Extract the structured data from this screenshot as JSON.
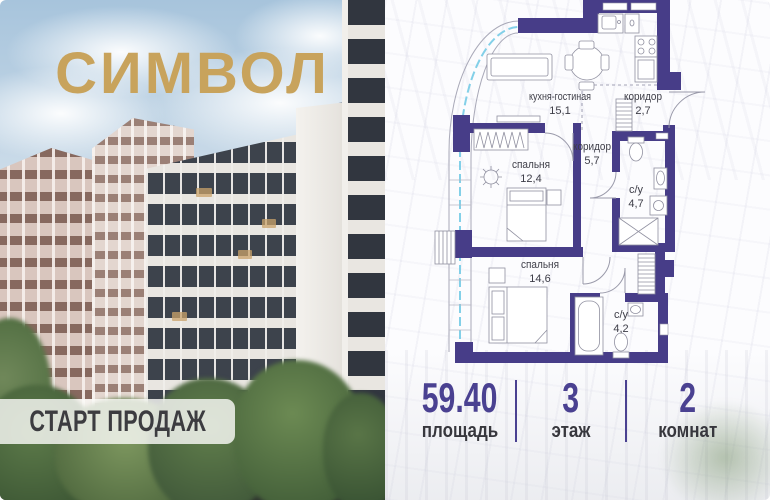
{
  "brand": {
    "logo": "СИМВОЛ",
    "logo_color": "#c8a35c"
  },
  "banner": {
    "label": "СТАРТ ПРОДАЖ"
  },
  "floorplan": {
    "wall_color": "#473d88",
    "glazing_color": "#76cbe6",
    "rooms": [
      {
        "name": "кухня-гостиная",
        "area": "15,1"
      },
      {
        "name": "коридор",
        "area": "2,7"
      },
      {
        "name": "коридор",
        "area": "5,7"
      },
      {
        "name": "спальня",
        "area": "12,4"
      },
      {
        "name": "с/у",
        "area": "4,7"
      },
      {
        "name": "спальня",
        "area": "14,6"
      },
      {
        "name": "с/у",
        "area": "4,2"
      }
    ]
  },
  "stats": {
    "accent_color": "#4a4191",
    "items": [
      {
        "value": "59.40",
        "label": "площадь"
      },
      {
        "value": "3",
        "label": "этаж"
      },
      {
        "value": "2",
        "label": "комнат"
      }
    ]
  }
}
